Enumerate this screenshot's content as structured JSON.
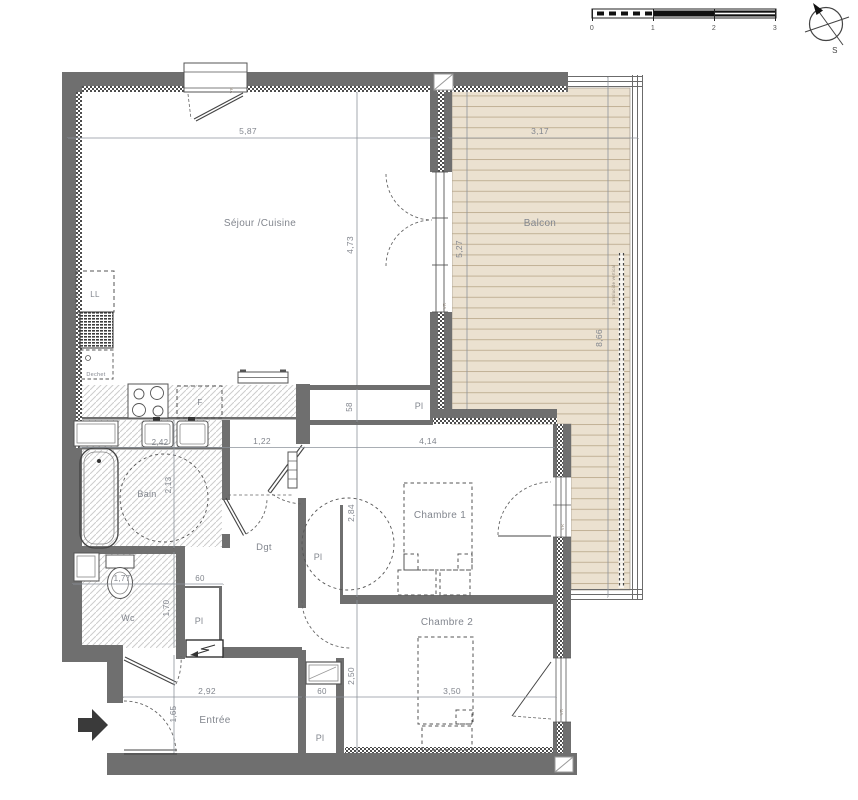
{
  "plan_title": "apartment-floor-plan",
  "colors": {
    "wall": "#6f6f6f",
    "deck": "#ebe1d0",
    "deck_line": "#c2b297",
    "hatch": "#cccccc",
    "text": "#82868e"
  },
  "rooms": {
    "sejour": {
      "label": "Séjour /Cuisine"
    },
    "balcon": {
      "label": "Balcon"
    },
    "chambre1": {
      "label": "Chambre 1"
    },
    "chambre2": {
      "label": "Chambre 2"
    },
    "bain": {
      "label": "Bain"
    },
    "wc": {
      "label": "Wc"
    },
    "entree": {
      "label": "Entrée"
    },
    "dgt": {
      "label": "Dgt"
    },
    "closet": {
      "label": "Pl"
    }
  },
  "fixtures": {
    "washer": "LL",
    "waste": "Dechet",
    "fridge": "F",
    "roller_shutter": "VR",
    "balcony_screen": "translucide vertical"
  },
  "dimensions": {
    "sejour_width": "5,87",
    "balcon_width": "3,17",
    "sejour_height": "4,73",
    "balcon_height": "5,27",
    "balcon_length": "8,66",
    "bain_width": "2,42",
    "dgt_width": "1,22",
    "chambre1_width": "4,14",
    "hall_closet_depth": "58",
    "chambre1_height": "2,84",
    "bain_height": "2,13",
    "wc_width": "1,77",
    "closet_width": "60",
    "wc_height": "1,70",
    "entree_width": "2,92",
    "entree_height": "1,65",
    "chambre2_width": "3,50",
    "chambre2_height": "2,50"
  },
  "scale_bar": {
    "ticks": [
      "0",
      "1",
      "2",
      "3"
    ]
  },
  "compass": {
    "south_label": "S"
  }
}
